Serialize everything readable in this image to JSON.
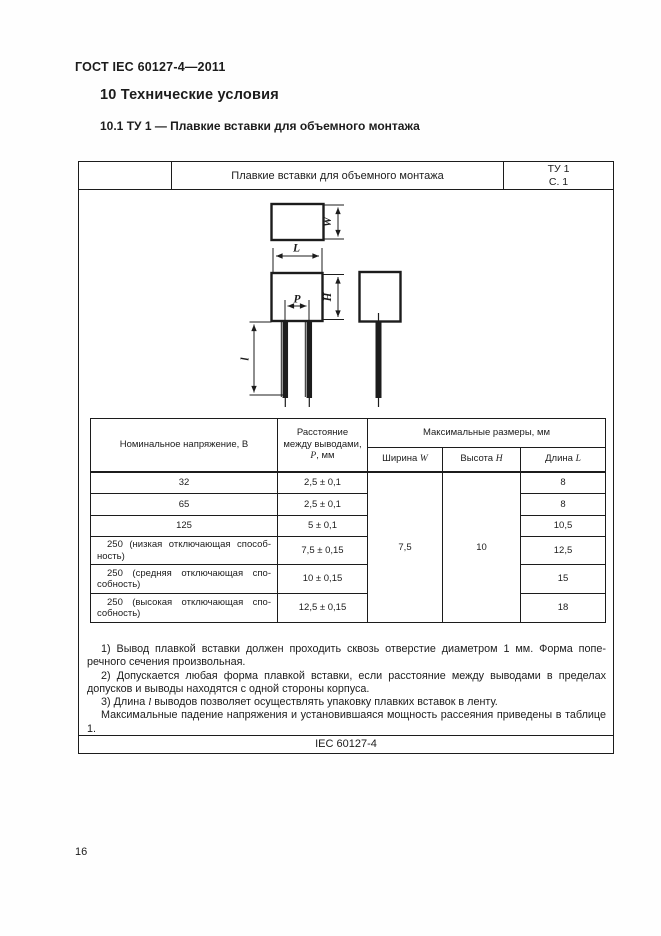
{
  "page": {
    "doc_number": "ГОСТ IEC 60127-4—2011",
    "section_heading": "10  Технические условия",
    "subsection_heading": "10.1  ТУ 1 — Плавкие вставки для объемного монтажа",
    "page_number": "16"
  },
  "spec_box": {
    "title": "Плавкие вставки для объемного монтажа",
    "ref_line1": "ТУ 1",
    "ref_line2": "С. 1",
    "footer": "IEC 60127-4"
  },
  "drawing": {
    "dim_labels": {
      "width": "W",
      "length": "L",
      "height": "H",
      "pitch": "P",
      "lead": "l"
    }
  },
  "table": {
    "header": {
      "voltage": "Номинальное напряжение, В",
      "distance_prefix": "Расстояние между выводами, ",
      "distance_symbol": "P",
      "distance_suffix": ", мм",
      "max_dims": "Максимальные размеры, мм",
      "width_prefix": "Ширина ",
      "width_symbol": "W",
      "height_prefix": "Высота ",
      "height_symbol": "H",
      "length_prefix": "Длина ",
      "length_symbol": "L"
    },
    "merged_width": "7,5",
    "merged_height": "10",
    "rows": [
      {
        "voltage": "32",
        "distance": "2,5 ± 0,1",
        "length": "8"
      },
      {
        "voltage": "65",
        "distance": "2,5 ± 0,1",
        "length": "8"
      },
      {
        "voltage": "125",
        "distance": "5 ± 0,1",
        "length": "10,5"
      },
      {
        "voltage": "250 (низкая отключающая способ­ность)",
        "distance": "7,5 ± 0,15",
        "length": "12,5"
      },
      {
        "voltage": "250 (средняя отключающая спо­собность)",
        "distance": "10 ± 0,15",
        "length": "15"
      },
      {
        "voltage": "250 (высокая отключающая спо­собность)",
        "distance": "12,5 ± 0,15",
        "length": "18"
      }
    ]
  },
  "notes": {
    "note1": "1)  Вывод плавкой вставки должен проходить сквозь отверстие диаметром 1 мм. Форма попе­речного сечения произвольная.",
    "note2": "2)  Допускается любая форма плавкой вставки, если расстояние между выводами в пределах допусков и выводы находятся с одной стороны корпуса.",
    "note3_prefix": "3)  Длина ",
    "note3_symbol": "l",
    "note3_suffix": " выводов позволяет осуществлять упаковку плавких вставок в ленту.",
    "note4": "Максимальные падение напряжения и установившаяся мощность рассеяния приведены в таб­лице 1."
  }
}
